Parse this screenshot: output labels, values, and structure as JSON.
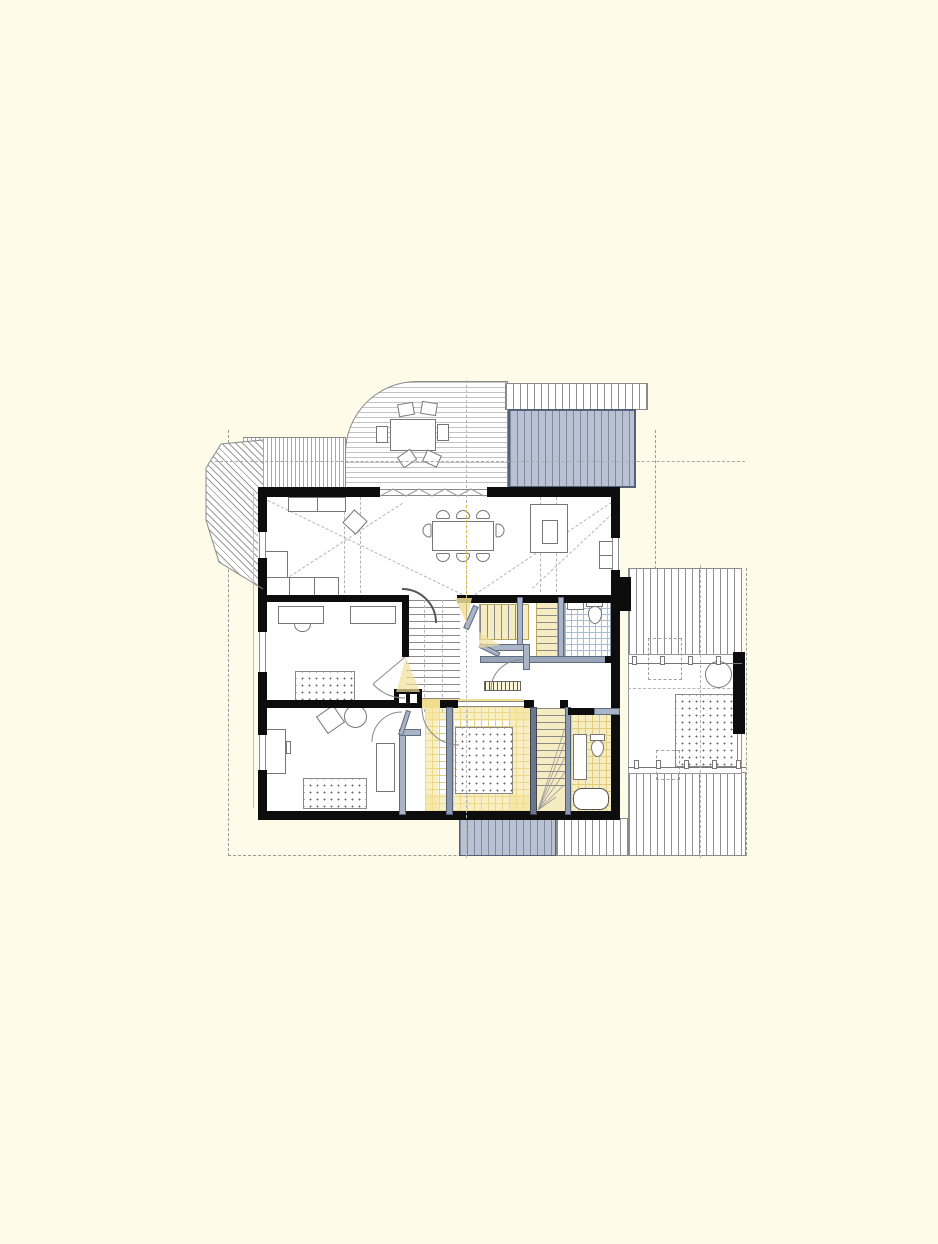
{
  "document": {
    "type": "architectural floor plan (CAD drawing, attic/upper storey)",
    "visible_text": [],
    "notes": "drawing contains no rendered text; content is line-work only"
  },
  "canvas": {
    "width": 938,
    "height": 1244,
    "background": "#FEFCE9"
  },
  "palette": {
    "paper_cream": "#FEFCE9",
    "wall_black": "#0d0d0d",
    "line_gray": "#8a8a8a",
    "faint_line": "#bbbbbb",
    "roof_fill_gray": "#b9c2d3",
    "roof_line_gray": "#7f8aa0",
    "roof_border": "#55617a",
    "new_partition_blue": "#a9b5c6",
    "highlight_yellow_fill": "#f6ecc2",
    "highlight_yellow_line": "#e2cd7e",
    "tile_blue_line": "#a9bcd4",
    "rug_dot_gray": "#6a6a6a"
  },
  "plan": {
    "outdoor": [
      {
        "name": "roof-terrace-deck",
        "feature": "rounded corner deck with round table and 5 chairs"
      },
      {
        "name": "gray-roof-top-right",
        "feature": "shaded lower roof"
      },
      {
        "name": "bay-window-roof-left",
        "feature": "hatched bay roof"
      },
      {
        "name": "side-wing-roof-top",
        "feature": "vertical hatched roof"
      },
      {
        "name": "side-wing-roof-bottom",
        "feature": "vertical hatched roof"
      },
      {
        "name": "gray-roof-bottom-strip",
        "feature": "shaded roof strip below south wall"
      }
    ],
    "rooms": [
      {
        "name": "living-room",
        "furniture": [
          "sideboard",
          "armchair-tilted",
          "corner-sofa"
        ]
      },
      {
        "name": "dining-hall",
        "furniture": [
          "dining-table",
          "8-chairs"
        ]
      },
      {
        "name": "kitchen",
        "furniture": [
          "island",
          "tall-cabinet"
        ]
      },
      {
        "name": "study",
        "furniture": [
          "two-desks",
          "chair",
          "dotted-rug"
        ]
      },
      {
        "name": "bedroom",
        "furniture": [
          "armchair-tilted",
          "round-chair",
          "desk",
          "dotted-rug",
          "wardrobe"
        ]
      },
      {
        "name": "bathroom-north",
        "floor": "blue tile grid",
        "fixtures": [
          "wc",
          "basin"
        ]
      },
      {
        "name": "bathroom-south",
        "floor": "yellow tile grid (new)",
        "fixtures": [
          "counter",
          "wc",
          "bathtub"
        ]
      },
      {
        "name": "yellow-room-south",
        "floor": "yellow tile grid (new)",
        "furniture": [
          "dotted-rug"
        ]
      },
      {
        "name": "side-wing-room",
        "furniture": [
          "round-chair",
          "dotted-rug"
        ]
      },
      {
        "name": "hallway",
        "features": [
          "radiator",
          "door-swings"
        ]
      }
    ],
    "stairs": [
      {
        "name": "main-stair-center",
        "direction": "vertical flight"
      },
      {
        "name": "upper-stair-highlighted",
        "direction": "horizontal flight, yellow"
      },
      {
        "name": "south-stair-winder",
        "direction": "vertical flight with fan winders, yellow"
      }
    ],
    "annotation_lines": [
      "dashed-property-boundary",
      "dash-dot-section-axis-horizontal",
      "dash-dot-axis-vertical",
      "yellow-axis-segment"
    ]
  }
}
